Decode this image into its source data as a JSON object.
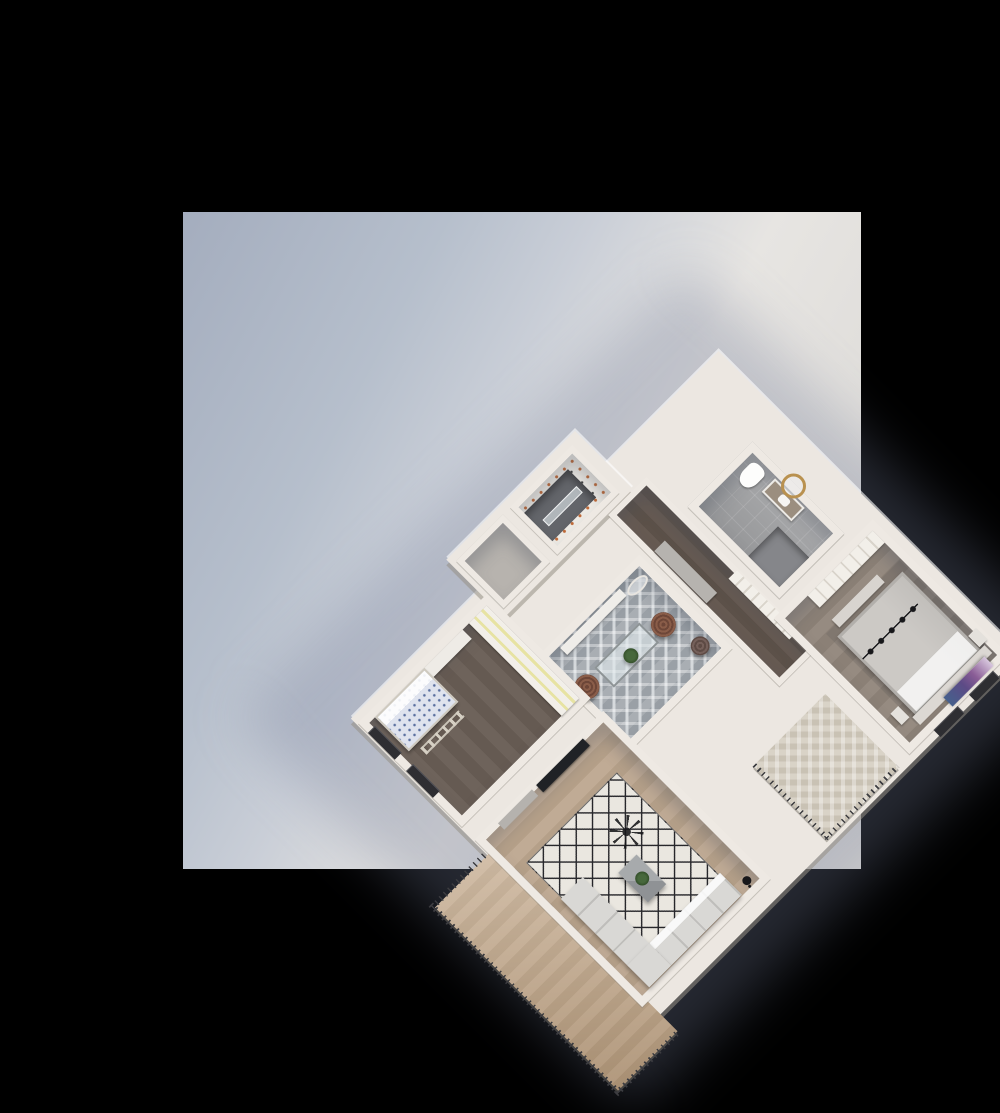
{
  "scene": {
    "type": "isometric-3d-floorplan-render",
    "description_labels": {
      "backdrop": "studio-backdrop-with-soft-shadow",
      "building": "one-bedroom-apartment-cutaway-top-view"
    },
    "rooms": [
      {
        "name": "bathroom",
        "furniture": [
          "toilet",
          "vanity-sink",
          "round-gold-mirror",
          "shower-area"
        ]
      },
      {
        "name": "wc-laundry",
        "furniture": [
          "speckled-wallpaper",
          "glass-shower-panel"
        ]
      },
      {
        "name": "storage",
        "furniture": []
      },
      {
        "name": "hallway",
        "furniture": [
          "gray-cabinet",
          "paneled-wardrobe"
        ]
      },
      {
        "name": "master-bedroom",
        "furniture": [
          "double-bed",
          "headboard",
          "purple-abstract-artwork",
          "nightstand",
          "nightstand",
          "black-track-chandelier",
          "closet",
          "foot-bench"
        ]
      },
      {
        "name": "dining-room",
        "furniture": [
          "glass-dining-table",
          "wicker-chair",
          "wicker-chair",
          "potted-plant",
          "wall-bench",
          "leaning-mirror",
          "pouf"
        ]
      },
      {
        "name": "kids-room",
        "furniture": [
          "yellow-accent-wardrobe",
          "desk",
          "patterned-bed",
          "loft-ladder"
        ]
      },
      {
        "name": "living-room",
        "furniture": [
          "l-shaped-sofa",
          "diamond-pattern-rug",
          "coffee-table",
          "potted-plant",
          "tv-screen",
          "media-console",
          "black-ceiling-fan",
          "floor-lamp"
        ]
      },
      {
        "name": "terrace",
        "furniture": [
          "wood-deck",
          "metal-railing",
          "sliding-doors"
        ]
      },
      {
        "name": "balcony",
        "furniture": [
          "herringbone-tile",
          "metal-railing"
        ]
      }
    ]
  },
  "colors": {
    "frame": "#000000",
    "bg1": "#a4adbe",
    "bg2": "#b6bfcc",
    "bg3": "#e7e5e2",
    "bg4": "#dedcd9",
    "shadow": "rgba(115,125,152,0.32)",
    "slab": "#ece7e1",
    "wall": "#eee9e3",
    "hall": "#665a52",
    "kids_floor": "#6e635b",
    "living_floor": "#c0ab95",
    "living_floor2": "#b5a089",
    "bed_floor": "#968b81",
    "bed_floor2": "#8b8076",
    "bath_tile": "#a0a1a3",
    "bath_dark": "#85868a",
    "chevron1": "#9aa0a6",
    "chevron2": "#d6dadd",
    "deck": "#c5ab8e",
    "deck2": "#b89e80",
    "balcony": "#d9d3c7",
    "balcony2": "#c9c2b4",
    "rail": "#3c3c40",
    "window": "#2e2e32",
    "rug": "#eae7e0",
    "rug_line": "#26262a",
    "sofa": "#d9d8d5",
    "sofa_line": "#bfbebb",
    "table": "#8f9295",
    "plant": "#47683c",
    "wicker": "#6d4638",
    "terra": "#c06a38",
    "yellow": "#e7e3a3",
    "gold": "#b9914f",
    "black": "#17171a",
    "art1": "#8a5d96",
    "art2": "#45608c",
    "art3": "#d8c7de",
    "bed_duvet": "#ccc9c5",
    "bed_frame": "#b2afab",
    "kidsbed": "#dfe3ee",
    "kidsbed_dot": "#5a6f9f",
    "glass": "rgba(225,232,236,0.62)",
    "wardrobe": "#f2efe9",
    "panel_line": "#d9d4cb",
    "cabinet": "#b6b3af",
    "storage": "#b7b3ae",
    "wc_floor": "#63656a",
    "wood_vanity": "#9b8e7f"
  }
}
